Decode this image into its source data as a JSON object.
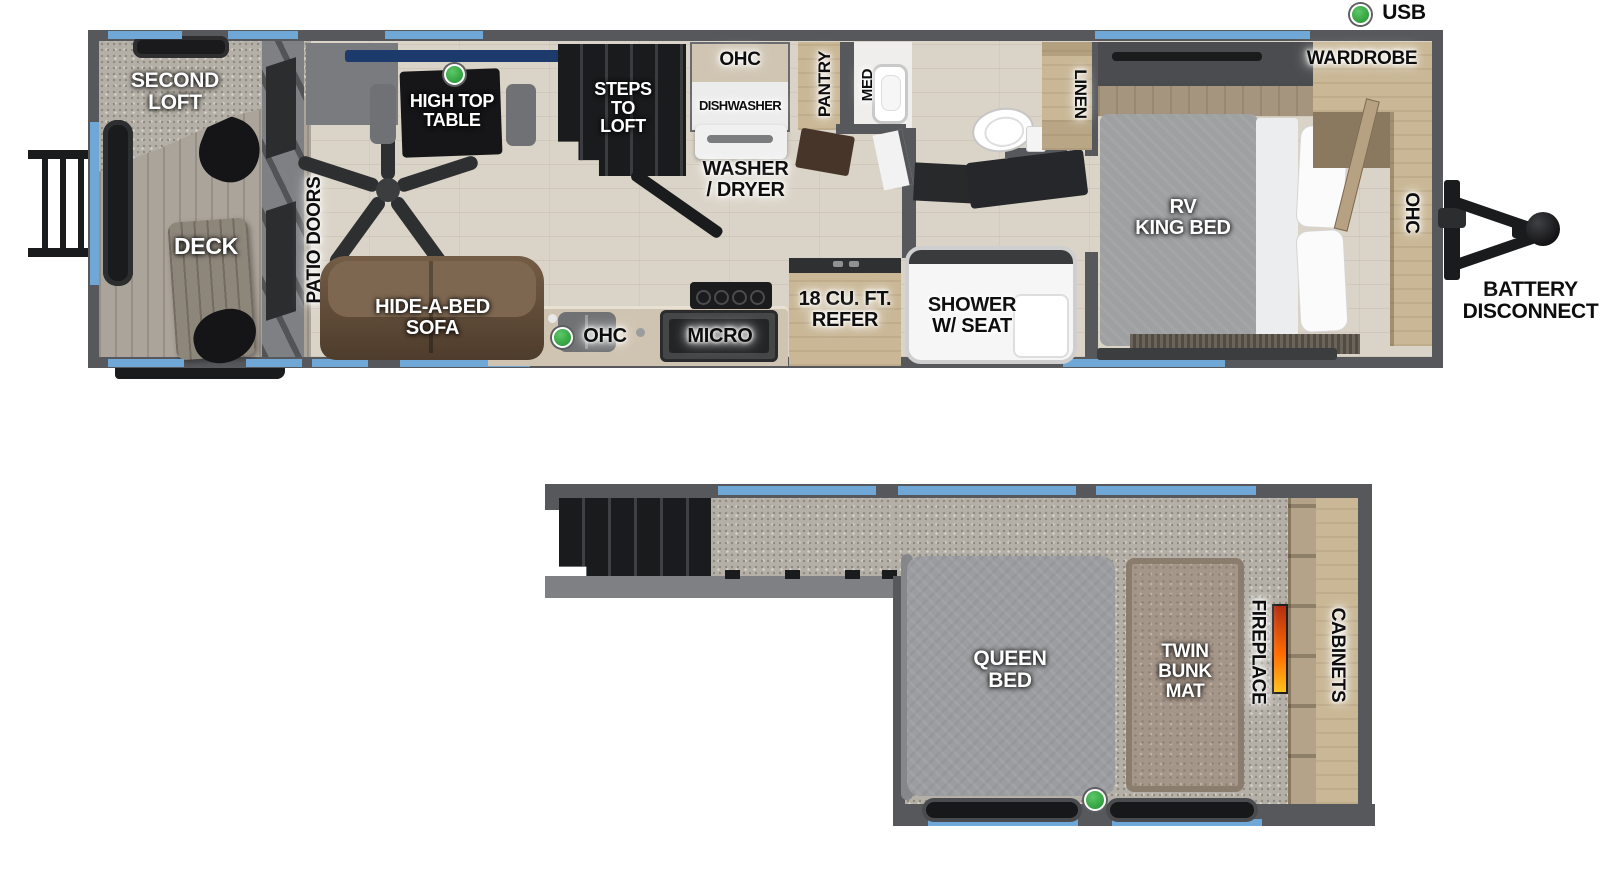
{
  "legend": {
    "usb": "USB"
  },
  "colors": {
    "wall": "#57585b",
    "window_blue": "#6fa8d6",
    "usb_green": "#3fae49",
    "floor_wood": "#dad3c7",
    "carpet": "#b5b0a7",
    "cabinet_wood": "#c9b795",
    "sofa_brown": "#6d5741",
    "bed_gray": "#9c9da0",
    "bunk_tan": "#a5968a",
    "fireplace_flame": "#ff6a00"
  },
  "main_floor": {
    "second_loft": "SECOND\nLOFT",
    "deck": "DECK",
    "patio_doors": "PATIO DOORS",
    "high_top_table": "HIGH TOP\nTABLE",
    "steps_to_loft": "STEPS\nTO\nLOFT",
    "ohc_dinette": "OHC",
    "dishwasher": "DISHWASHER",
    "pantry": "PANTRY",
    "med": "MED",
    "washer_dryer": "WASHER\n/ DRYER",
    "linen": "LINEN",
    "wardrobe": "WARDROBE",
    "rv_king_bed": "RV\nKING BED",
    "ohc_bedroom": "OHC",
    "battery_disconnect": "BATTERY\nDISCONNECT",
    "hide_a_bed_sofa": "HIDE-A-BED\nSOFA",
    "ohc_kitchen": "OHC",
    "micro": "MICRO",
    "refer": "18 CU. FT.\nREFER",
    "shower": "SHOWER\nW/ SEAT"
  },
  "loft": {
    "queen_bed": "QUEEN\nBED",
    "twin_bunk_mat": "TWIN\nBUNK\nMAT",
    "fireplace": "FIREPLACE",
    "cabinets": "CABINETS"
  }
}
